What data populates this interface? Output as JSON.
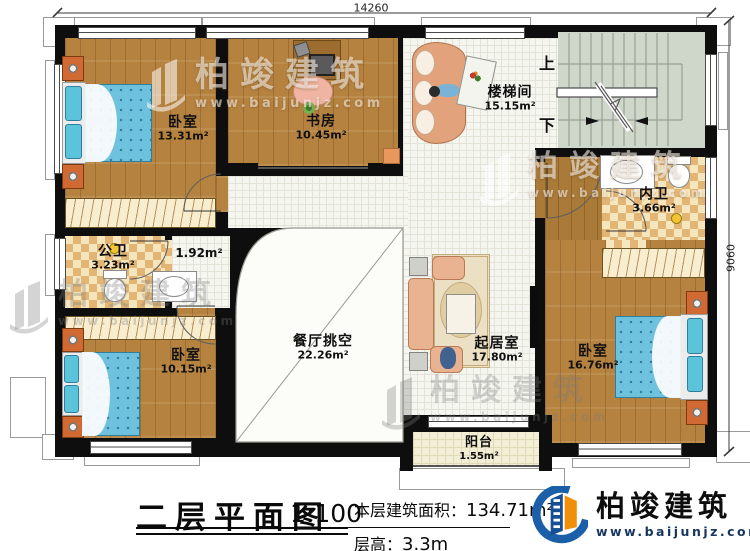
{
  "dimensions": {
    "top": "14260",
    "right": "9060"
  },
  "stairs": {
    "up_label": "上",
    "down_label": "下"
  },
  "rooms": {
    "bedroom_tl": {
      "name": "卧室",
      "area": "13.31m²"
    },
    "study": {
      "name": "书房",
      "area": "10.45m²"
    },
    "stairwell": {
      "name": "楼梯间",
      "area": "15.15m²"
    },
    "bath_private": {
      "name": "内卫",
      "area": "3.66m²"
    },
    "bath_public": {
      "name": "公卫",
      "area": "3.23m²"
    },
    "hallway": {
      "area": "1.92m²"
    },
    "bedroom_bl": {
      "name": "卧室",
      "area": "10.15m²"
    },
    "dining_void": {
      "name": "餐厅挑空",
      "area": "22.26m²"
    },
    "living": {
      "name": "起居室",
      "area": "17.80m²"
    },
    "bedroom_r": {
      "name": "卧室",
      "area": "16.76m²"
    },
    "balcony": {
      "name": "阳台",
      "area": "1.55m²"
    }
  },
  "title_block": {
    "title": "二层平面图",
    "scale": "1:100",
    "floor_area_label": "本层建筑面积：",
    "floor_area_value": "134.71m²",
    "floor_height_label": "层高：",
    "floor_height_value": "3.3m"
  },
  "brand": {
    "name": "柏竣建筑",
    "website": "www.baijunjz.com"
  },
  "watermark": {
    "name": "柏竣建筑",
    "website": "www.baijunjz.com"
  },
  "colors": {
    "wall": "#0e0e0e",
    "wood": "#b5823f",
    "bed_blue": "#6ec2de",
    "brand_blue": "#1b5fa8",
    "brand_orange": "#f0900a"
  }
}
